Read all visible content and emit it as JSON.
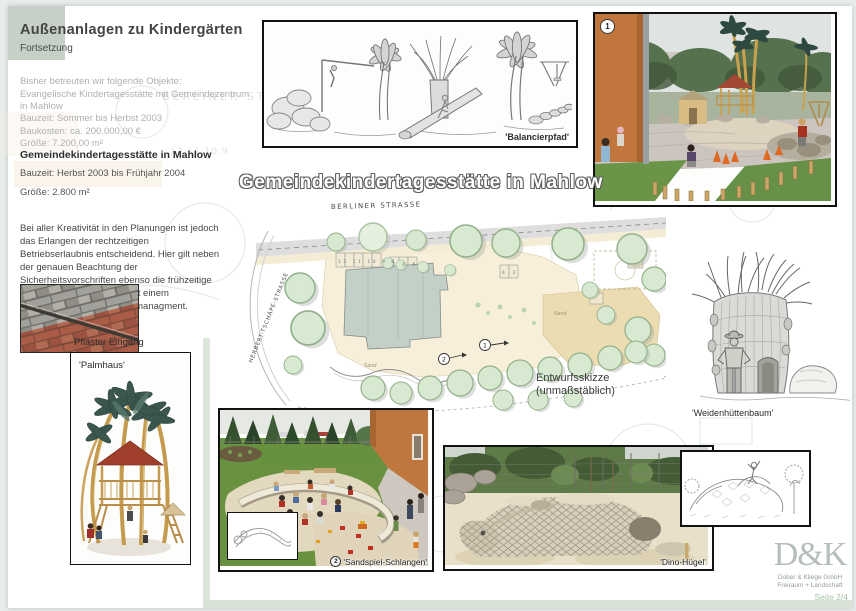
{
  "header": {
    "title": "Außenanlagen zu Kindergärten",
    "subtitle": "Fortsetzung"
  },
  "intro": {
    "lines": [
      "Bisher betreuten wir folgende Objekte:",
      "Evangelische Kindertagesstätte mit Gemeindezentrum",
      "in Mahlow"
    ]
  },
  "project_prev": {
    "lines": [
      "Bauzeit: Sommer bis Herbst 2003",
      "Baukosten: ca. 200.000,00 €",
      "Größe: 7.200,00 m²"
    ]
  },
  "project_current": {
    "title": "Gemeindekindertagesstätte in Mahlow",
    "bauzeit": "Bauzeit: Herbst 2003 bis Frühjahr 2004",
    "groesse": "Größe: 2.800 m²"
  },
  "note": "Bei aller Kreativität in den Planungen ist jedoch das Erlangen der rechtzeitigen Betriebserlaubnis entscheidend. Hier gilt neben der genauen Beachtung der Sicherheitsvorschriften ebenso die frühzeitige Fertigstellung der Anlage mit einem entsprechenden Baustellenmanagment.",
  "main_title": "Gemeindekindertagesstätte in Mahlow",
  "captions": {
    "balancierpfad": "'Balancierpfad'",
    "pflaster": "Pflaster Eingang",
    "palmhaus": "'Palmhaus'",
    "weidenhuettenbaum": "'Weidenhüttenbaum'",
    "sandspiel": "'Sandspiel-Schlangen'",
    "dino": "'Dino-Hügel'"
  },
  "badges": {
    "photo1": "1",
    "sandspiel": "2"
  },
  "plan": {
    "street_top": "BERLINER STRASSE",
    "street_left": "HERBERT-TSCHÄPE-STRASSE",
    "caption1": "Entwurfsskizze",
    "caption2": "(unmaßstäblich)",
    "marker1": "1",
    "marker2": "2",
    "parking_row1": "12 11 10 9 8",
    "parking_row2": "7 6 5",
    "parking_row3": "4 3",
    "sand1": "Sand",
    "sand2": "Sand"
  },
  "watermark": {
    "text1": "BERLINER STR",
    "text2": "12.11.10.9"
  },
  "footer": {
    "logo": "D&K",
    "company1": "Dober & Kliege GmbH",
    "company2": "Freiraum + Landschaft",
    "page": "Seite 2/4"
  },
  "colors": {
    "accent_green": "#d8e3d6",
    "header_square": "#c6d0c6",
    "title_outline": "#616161",
    "photo_border": "#121212",
    "plan_tree": "#d8e9d1",
    "plan_cream": "#f7efda",
    "page_footer_green": "#a3c2a6"
  }
}
